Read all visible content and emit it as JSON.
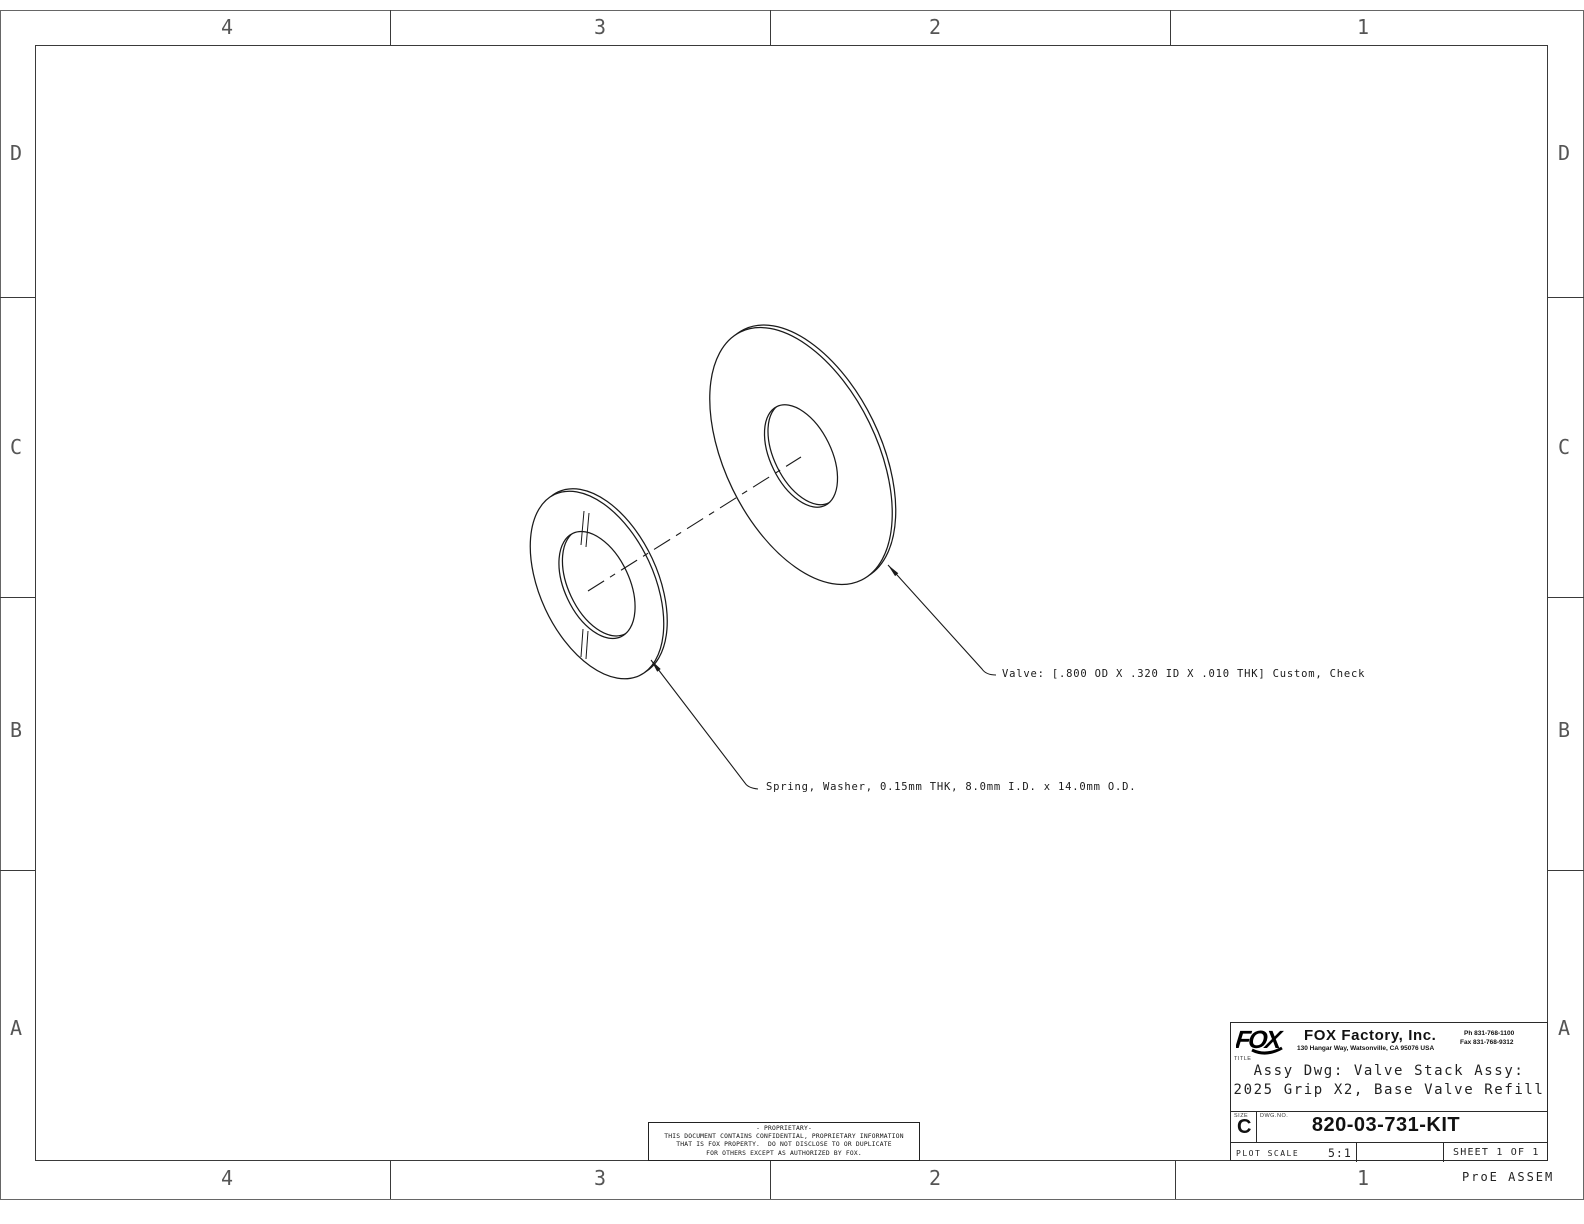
{
  "sheet": {
    "zone_columns": [
      "4",
      "3",
      "2",
      "1"
    ],
    "zone_rows": [
      "D",
      "C",
      "B",
      "A"
    ],
    "footer_note": "ProE ASSEM"
  },
  "callouts": {
    "valve": "Valve: [.800 OD X .320 ID X .010 THK] Custom, Check",
    "spring_washer": "Spring, Washer, 0.15mm THK, 8.0mm I.D. x 14.0mm O.D."
  },
  "title_block": {
    "logo_text": "FOX",
    "company": "FOX Factory, Inc.",
    "address": "130 Hangar Way, Watsonville, CA 95076 USA",
    "phone": "Ph 831-768-1100",
    "fax": "Fax 831-768-9312",
    "title_label": "TITLE",
    "title_line1": "Assy Dwg: Valve Stack Assy:",
    "title_line2": "2025 Grip X2, Base Valve Refill",
    "size_label": "SIZE",
    "size_value": "C",
    "dwg_no_label": "DWG.NO.",
    "dwg_no": "820-03-731-KIT",
    "plot_scale_label": "PLOT SCALE",
    "plot_scale_value": "5:1",
    "sheet_text": "SHEET 1 OF 1"
  },
  "proprietary": {
    "line1": "- PROPRIETARY-",
    "line2": "THIS DOCUMENT CONTAINS CONFIDENTIAL, PROPRIETARY INFORMATION",
    "line3": "THAT IS FOX PROPERTY.  DO NOT DISCLOSE TO OR DUPLICATE",
    "line4": "FOR OTHERS EXCEPT AS AUTHORIZED BY FOX."
  }
}
